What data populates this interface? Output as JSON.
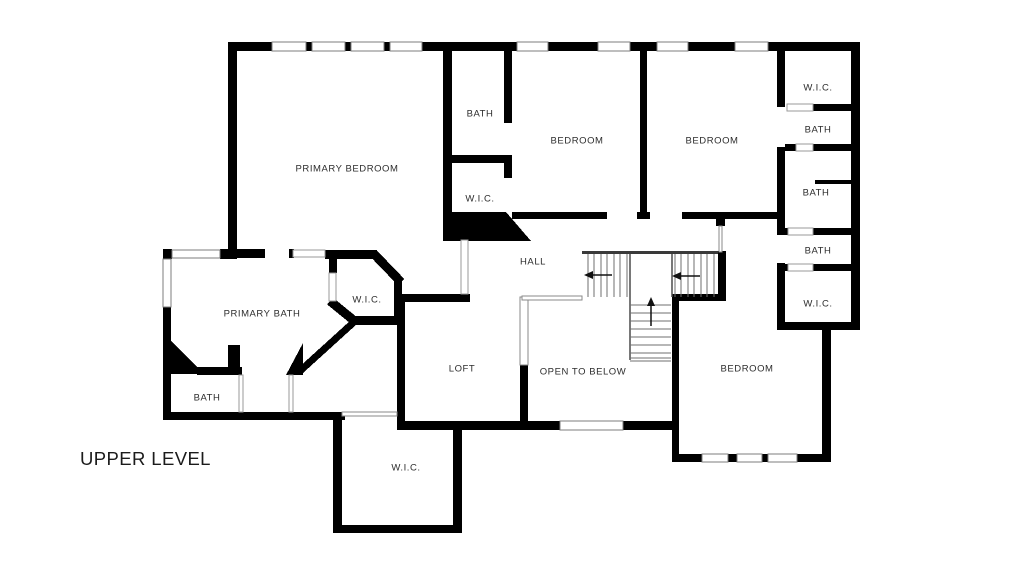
{
  "title": "UPPER LEVEL",
  "colors": {
    "wall": "#000000",
    "background": "#ffffff",
    "thin_line": "#8a8a8a",
    "text": "#2d2d2d"
  },
  "rooms": [
    {
      "id": "primary-bedroom",
      "label": "PRIMARY BEDROOM"
    },
    {
      "id": "bath-ensuite",
      "label": "BATH"
    },
    {
      "id": "wic-ensuite",
      "label": "W.I.C."
    },
    {
      "id": "bedroom-1",
      "label": "BEDROOM"
    },
    {
      "id": "bedroom-2",
      "label": "BEDROOM"
    },
    {
      "id": "wic-right-top",
      "label": "W.I.C."
    },
    {
      "id": "bath-right-1",
      "label": "BATH"
    },
    {
      "id": "bath-right-2",
      "label": "BATH"
    },
    {
      "id": "bath-right-3",
      "label": "BATH"
    },
    {
      "id": "wic-right-bottom",
      "label": "W.I.C."
    },
    {
      "id": "hall",
      "label": "HALL"
    },
    {
      "id": "primary-bath",
      "label": "PRIMARY BATH"
    },
    {
      "id": "wic-primary",
      "label": "W.I.C."
    },
    {
      "id": "loft",
      "label": "LOFT"
    },
    {
      "id": "open-to-below",
      "label": "OPEN TO BELOW"
    },
    {
      "id": "bedroom-3",
      "label": "BEDROOM"
    },
    {
      "id": "bath-lower",
      "label": "BATH"
    },
    {
      "id": "wic-lower",
      "label": "W.I.C."
    }
  ]
}
